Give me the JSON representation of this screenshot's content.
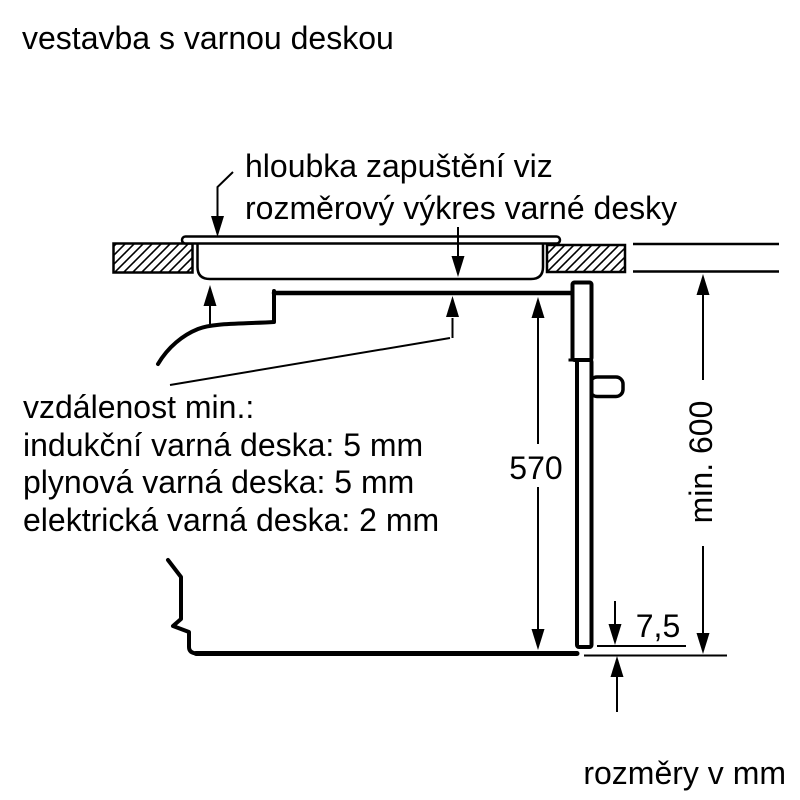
{
  "title": "vestavba s varnou deskou",
  "footer_note": "rozměry v mm",
  "annotations": {
    "recess_note": {
      "line1": "hloubka zapuštění viz",
      "line2": "rozměrový výkres varné desky"
    },
    "min_distance_note": {
      "line1": "vzdálenost min.:",
      "line2": "indukční varná deska: 5 mm",
      "line3": "plynová varná deska: 5 mm",
      "line4": "elektrická varná deska: 2 mm"
    }
  },
  "dimensions": {
    "oven_front_height_mm": "570",
    "niche_min_height_mm": "min. 600",
    "door_bottom_gap_mm": "7,5"
  },
  "colors": {
    "line": "#000000",
    "background": "#ffffff"
  }
}
